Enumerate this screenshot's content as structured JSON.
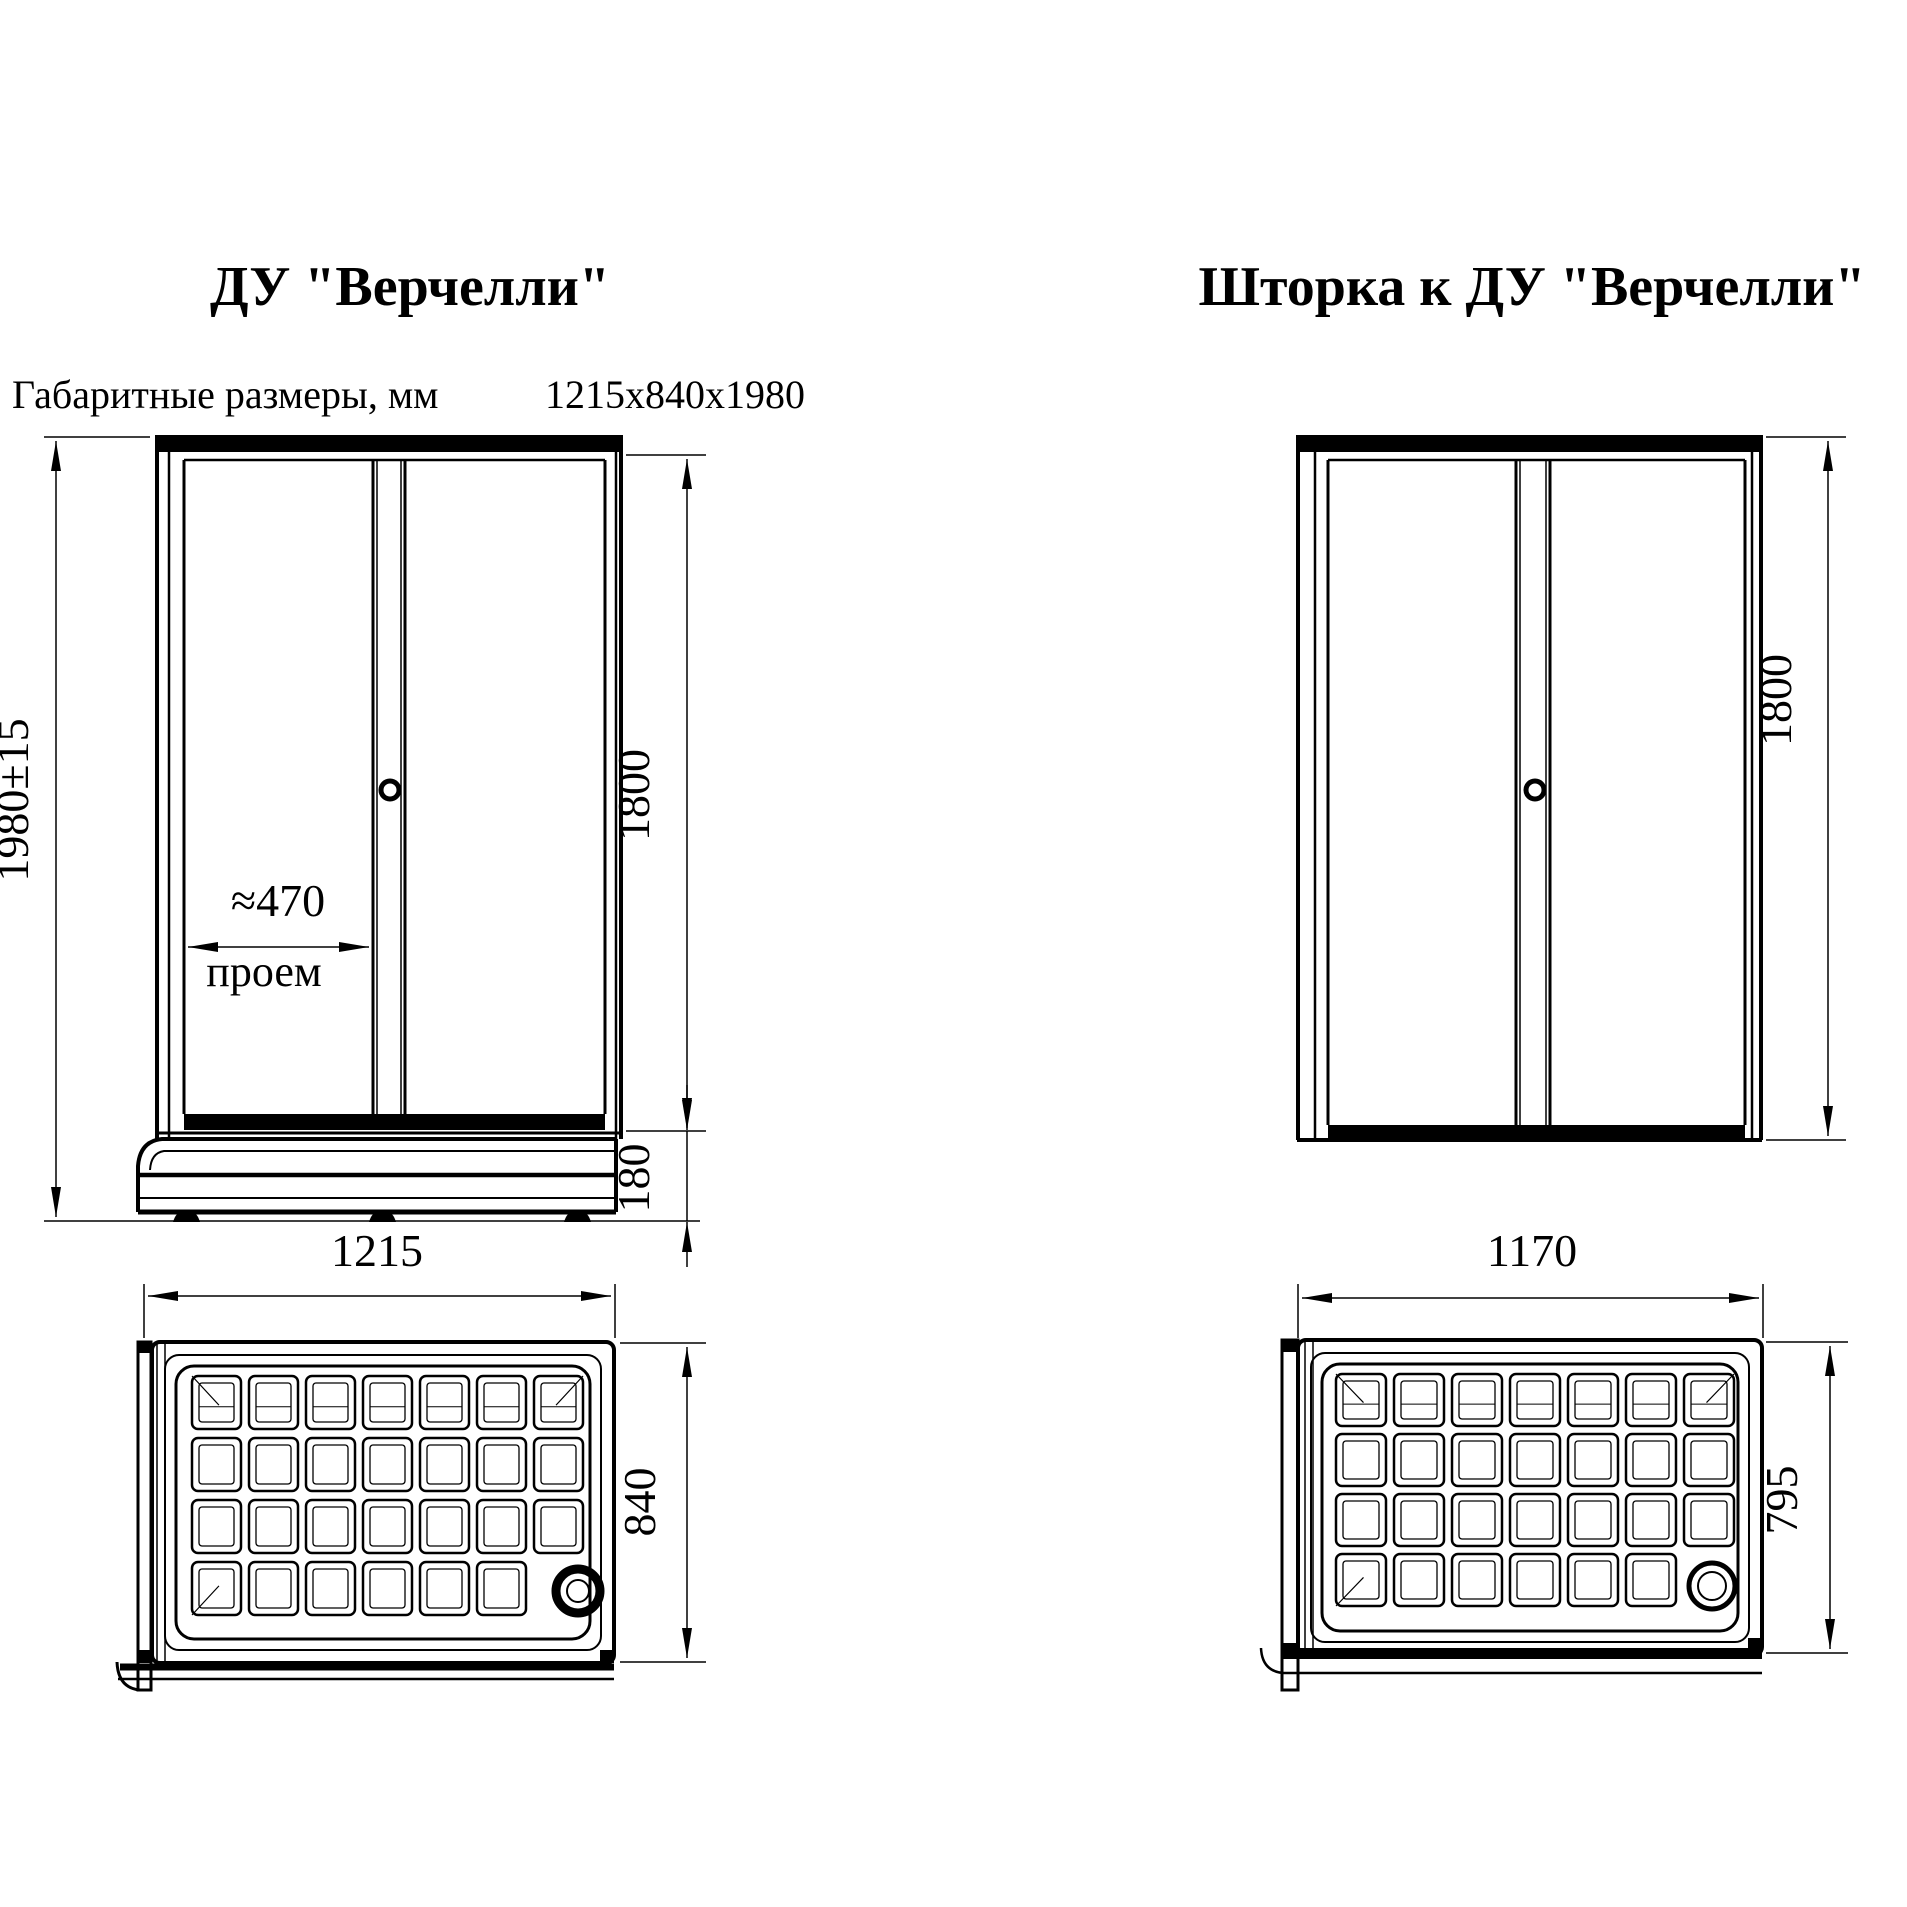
{
  "page": {
    "background": "#ffffff",
    "ink": "#000000"
  },
  "left_unit": {
    "title": "ДУ \"Верчелли\"",
    "spec_label": "Габаритные размеры, мм",
    "spec_value": "1215x840x1980",
    "front_view": {
      "overall_height": "1980±15",
      "door_height": "1800",
      "tray_height": "180",
      "opening_width": "≈470",
      "opening_caption": "проем"
    },
    "plan_view": {
      "width": "1215",
      "depth": "840"
    }
  },
  "right_unit": {
    "title": "Шторка к ДУ \"Верчелли\"",
    "front_view": {
      "door_height": "1800"
    },
    "plan_view": {
      "width": "1170",
      "depth": "795"
    }
  }
}
